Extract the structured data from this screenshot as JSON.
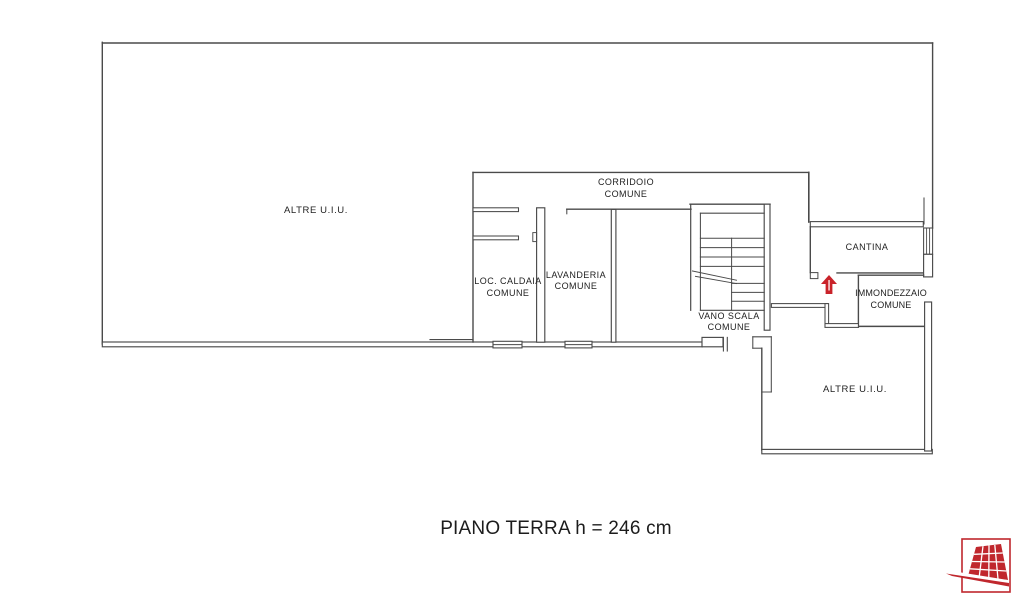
{
  "plan": {
    "title": "PIANO TERRA h = 246 cm",
    "rooms": {
      "altre_left": {
        "label": "ALTRE U.I.U."
      },
      "corridoio": {
        "line1": "CORRIDOIO",
        "line2": "COMUNE"
      },
      "loc_caldaia": {
        "line1": "LOC. CALDAIA",
        "line2": "COMUNE"
      },
      "lavanderia": {
        "line1": "LAVANDERIA",
        "line2": "COMUNE"
      },
      "vano_scala": {
        "line1": "VANO SCALA",
        "line2": "COMUNE"
      },
      "cantina": {
        "label": "CANTINA"
      },
      "immondezzaio": {
        "line1": "IMMONDEZZAIO",
        "line2": "COMUNE"
      },
      "altre_bottom": {
        "label": "ALTRE U.I.U."
      }
    },
    "icons": {
      "entrance_arrow": "red-up-arrow-entrance",
      "brand_logo": "red-perspective-tiles-logo"
    },
    "colors": {
      "wall_line": "#4a4a4a",
      "label_text": "#222222",
      "accent_red": "#c9232a"
    }
  }
}
